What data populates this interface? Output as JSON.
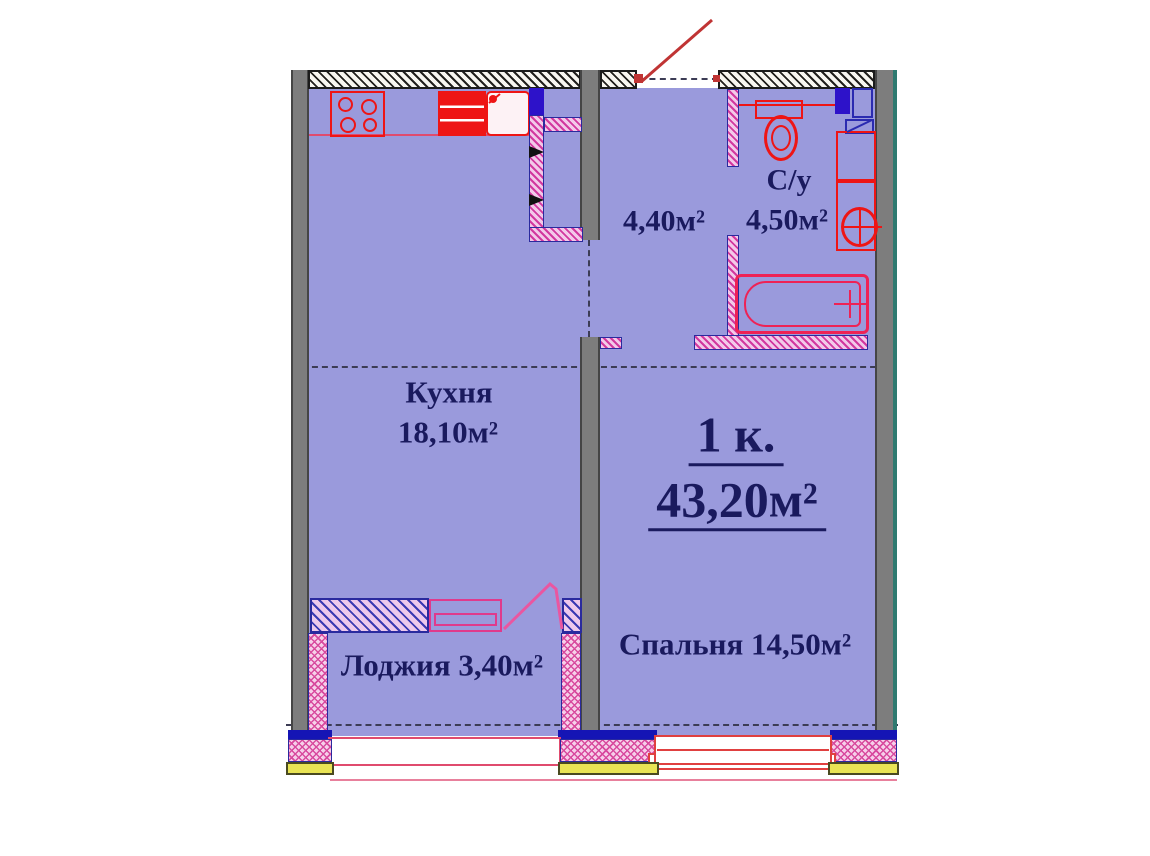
{
  "plan": {
    "unit": {
      "rooms_label": "1 к.",
      "total_area": "43,20м²"
    },
    "rooms": {
      "kitchen": {
        "label": "Кухня",
        "area": "18,10м²"
      },
      "hallway": {
        "area": "4,40м²"
      },
      "bathroom": {
        "label": "С/у",
        "area": "4,50м²"
      },
      "bedroom": {
        "label": "Спальня",
        "area": "14,50м²"
      },
      "loggia": {
        "label": "Лоджия",
        "area": "3,40м²"
      }
    },
    "icons": {
      "stove": "stove-icon",
      "kitchen_sink": "kitchen-sink-icon",
      "vent_shaft": "vent-shaft-icon",
      "toilet": "toilet-icon",
      "washing_machine": "washing-machine-icon",
      "washbasin": "washbasin-icon",
      "bathtub": "bathtub-icon",
      "entry_door": "door-swing-icon",
      "balcony_door": "door-swing-icon",
      "window": "window-icon"
    },
    "colors": {
      "floor": "#9a9adc",
      "wall_gray": "#7d7d7d",
      "wall_teal_edge": "#2f7a70",
      "hatch_black": "#1b1b1b",
      "partition_pink": "#d2389f",
      "partition_border": "#2a2a9e",
      "fixture_red": "#ee1515",
      "fixture_pink": "#e03a8c",
      "duct_blue": "#2d12c9",
      "window_frame_blue": "#1515b5",
      "sill_yellow": "#e9e455",
      "door_swing_red": "#c03434",
      "text_navy": "#1a1a5e"
    }
  }
}
